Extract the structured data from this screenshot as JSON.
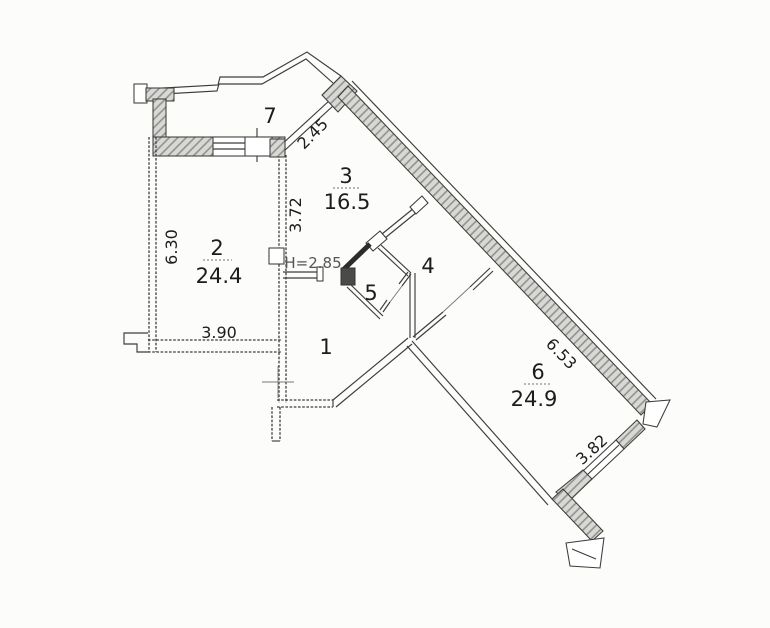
{
  "rooms": [
    {
      "number": "1"
    },
    {
      "number": "2",
      "area": "24.4"
    },
    {
      "number": "3",
      "area": "16.5"
    },
    {
      "number": "4"
    },
    {
      "number": "5"
    },
    {
      "number": "6",
      "area": "24.9"
    },
    {
      "number": "7"
    }
  ],
  "dimensions": {
    "room2_height": "6.30",
    "room2_width": "3.90",
    "room2_3_wall": "3.72",
    "room3_window": "2.45",
    "ceiling_height": "H=2.85",
    "room6_length": "6.53",
    "room6_width": "3.82"
  },
  "colors": {
    "background": "#fcfcfa",
    "line": "#3c3c3c",
    "wall_dark": "#2c2c2c",
    "text": "#1c1c1c",
    "height_text": "#555555"
  }
}
